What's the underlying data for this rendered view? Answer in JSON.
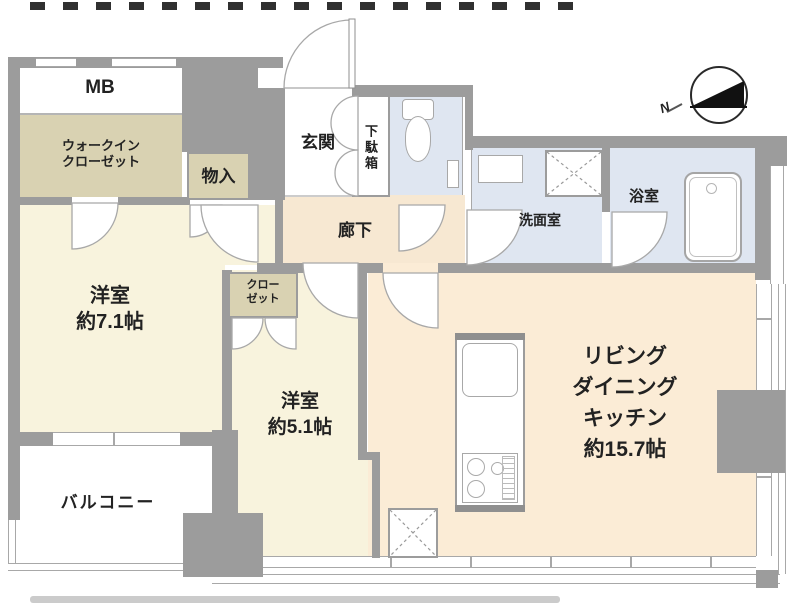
{
  "colors": {
    "wall": "#9c9c9c",
    "line": "#a8a8a8",
    "cream": "#f8f3dd",
    "tan": "#d9d2b2",
    "peach": "#fbecd6",
    "hall": "#f7e8d2",
    "blue": "#dfe6f1",
    "text": "#222222"
  },
  "rooms": {
    "mb": {
      "label": "MB"
    },
    "walk_in_closet": {
      "line1": "ウォークイン",
      "line2": "クローゼット"
    },
    "storage": {
      "label": "物入"
    },
    "entrance": {
      "label": "玄関"
    },
    "shoe_cabinet": {
      "label": "下駄箱"
    },
    "hallway": {
      "label": "廊下"
    },
    "washroom": {
      "label": "洗面室"
    },
    "bathroom": {
      "label": "浴室"
    },
    "bedroom_1": {
      "name": "洋室",
      "size": "約7.1帖"
    },
    "closet": {
      "line1": "クロー",
      "line2": "ゼット"
    },
    "bedroom_2": {
      "name": "洋室",
      "size": "約5.1帖"
    },
    "balcony": {
      "label": "バルコニー"
    },
    "ldk": {
      "line1": "リビング",
      "line2": "ダイニング",
      "line3": "キッチン",
      "line4": "約15.7帖"
    }
  },
  "compass": {
    "north_label": "N"
  }
}
